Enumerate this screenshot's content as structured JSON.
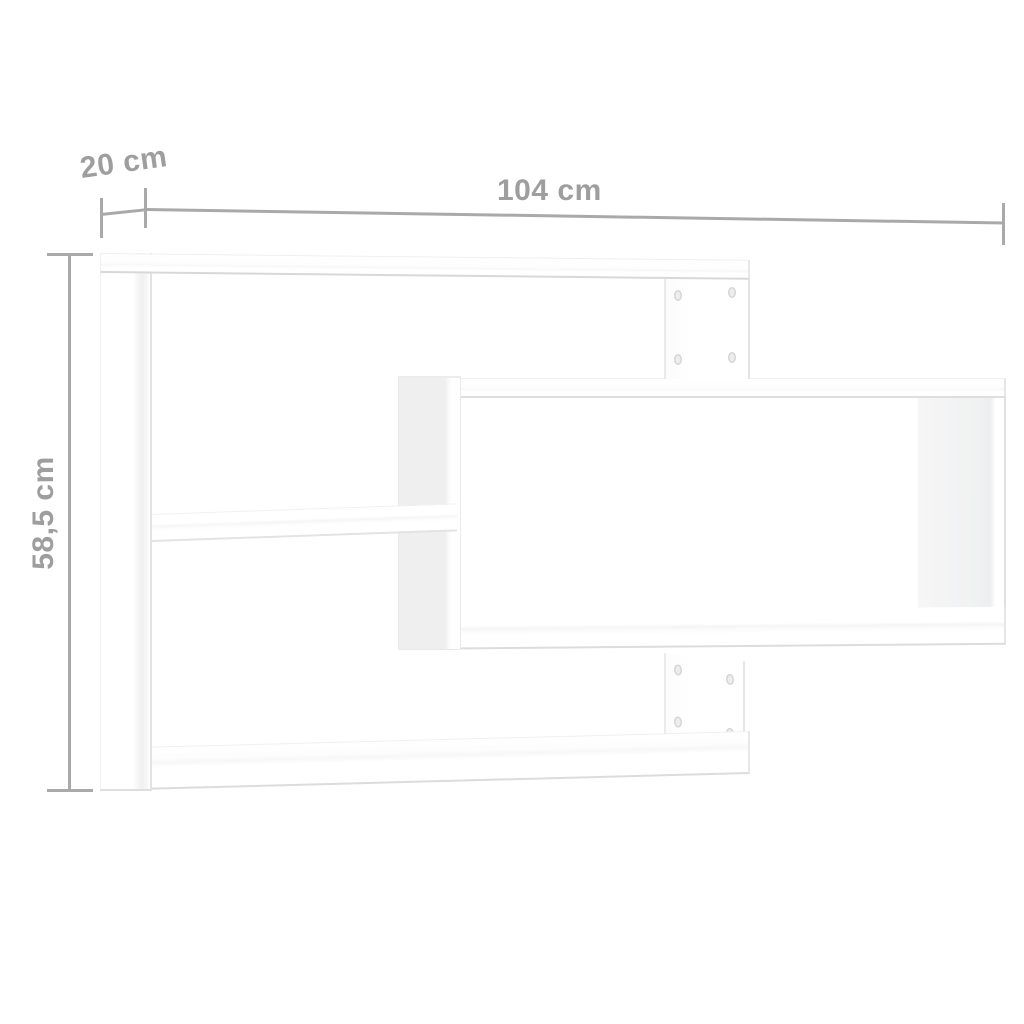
{
  "diagram": {
    "subject": "White wall-mounted shelf with three staggered rectangular compartments, shown with measurement annotations",
    "background_color": "#ffffff",
    "annotation_line_color": "#a9a9a9",
    "annotation_text_color": "#9e9e9e",
    "board_fill_color": "#ffffff",
    "board_edge_color": "#e0e0e0",
    "board_side_shading_color": "#f0f0f0"
  },
  "dimensions": {
    "depth_label": "20 cm",
    "width_label": "104 cm",
    "height_label": "58,5 cm"
  }
}
